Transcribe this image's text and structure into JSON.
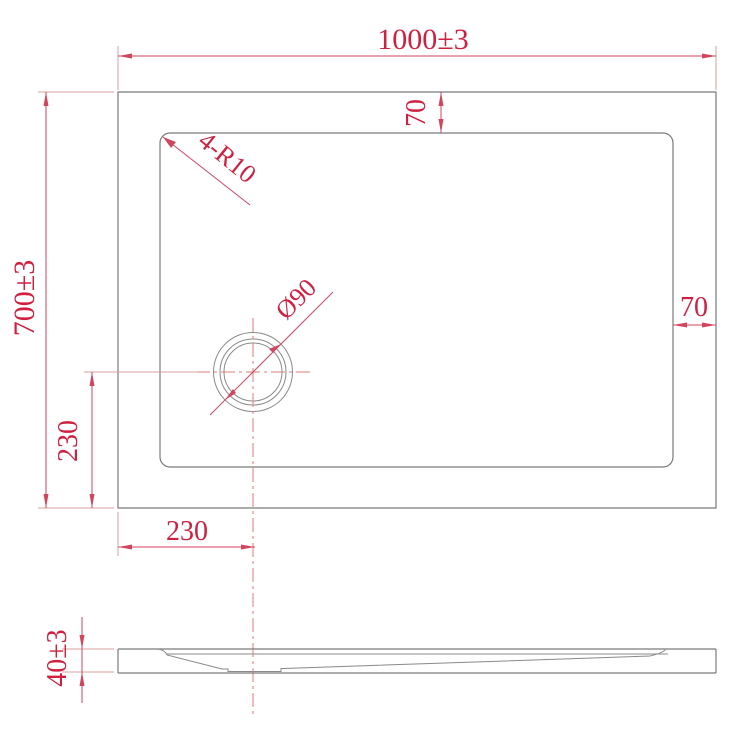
{
  "drawing": {
    "kind": "shower-tray-technical-drawing",
    "colors": {
      "dimension_red": "#d1455f",
      "dimension_text_red": "#cf2040",
      "centerline_pink": "#e07a7a",
      "geometry_gray": "#7a7a7a",
      "background": "#ffffff"
    },
    "plan_view": {
      "overall_width_dim": "1000±3",
      "overall_height_dim": "700±3",
      "rim_top_dim": "70",
      "rim_right_dim": "70",
      "drain_offset_left_dim": "230",
      "drain_offset_bottom_dim": "230",
      "corner_radius_label": "4-R10",
      "drain_diameter_label": "Ø90"
    },
    "side_view": {
      "thickness_dim": "40±3"
    }
  }
}
